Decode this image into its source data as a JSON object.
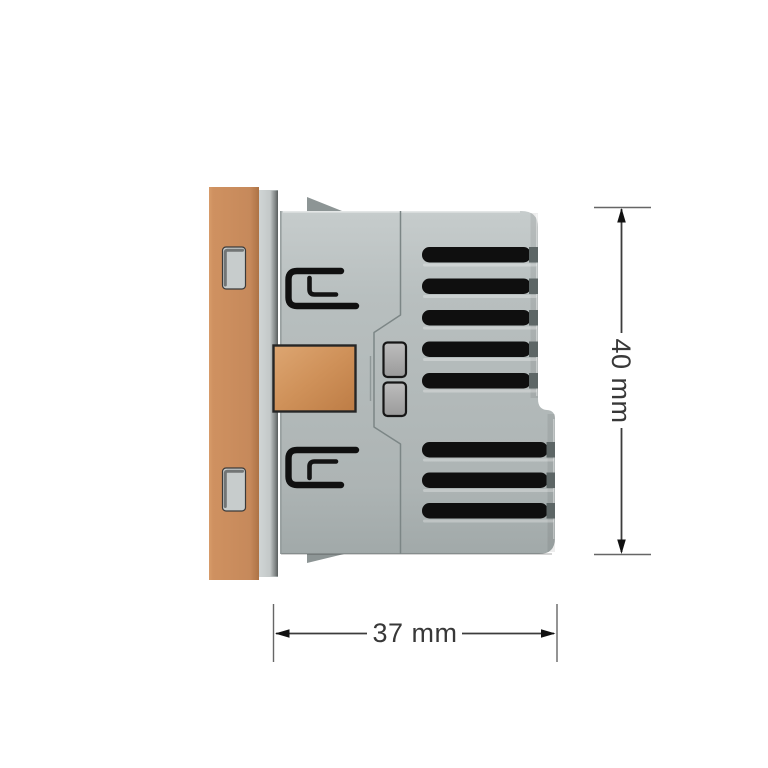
{
  "dimensions": {
    "height": {
      "label": "40 mm",
      "value": 40,
      "unit": "mm"
    },
    "width": {
      "label": "37 mm",
      "value": 37,
      "unit": "mm"
    }
  },
  "device_features": {
    "top_vent_slots": 5,
    "bottom_vent_slots": 3,
    "front_plate_slots": 2,
    "mounting_clips": 2,
    "side_buttons": 2,
    "copper_terminals": 1
  },
  "colors": {
    "background": "#ffffff",
    "copper_plate": "#ca8d5c",
    "copper_terminal": "#cf9159",
    "body_gray": "#b4bbbb",
    "frame_gray": "#c6cbcb",
    "vent_black": "#0f0f0f",
    "vent_cap_gray": "#5d6666",
    "button_gray": "#a9a9a9",
    "dimension_line": "#3c3c3c",
    "dimension_text": "#383838"
  }
}
